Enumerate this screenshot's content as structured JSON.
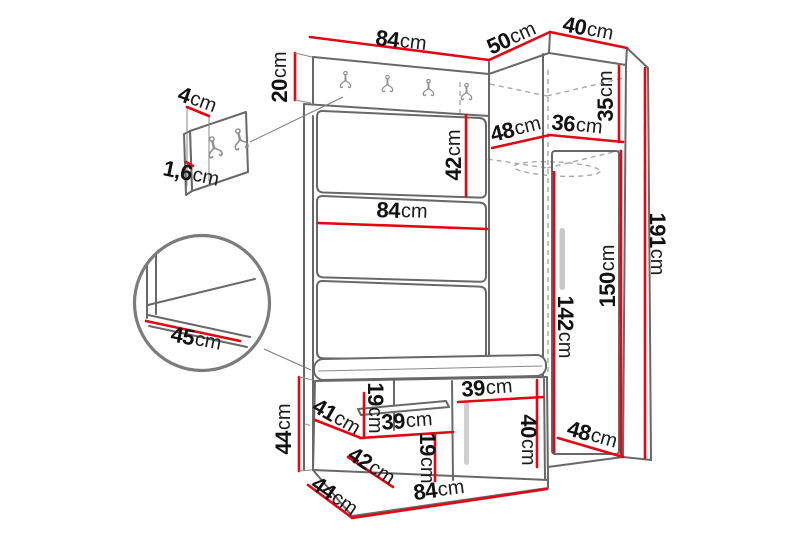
{
  "diagram": {
    "kind": "furniture-dimension-drawing",
    "unit": "cm",
    "colors": {
      "dimension_line": "#e30613",
      "outline": "#686868",
      "hidden_line": "#a9a9a9",
      "text": "#111111",
      "background": "#ffffff"
    },
    "icons": [
      {
        "name": "double-coat-hook",
        "count": 6
      },
      {
        "name": "magnifier-detail-circle",
        "count": 1
      }
    ]
  },
  "dims": [
    {
      "id": "top-width",
      "num": "84",
      "unit": "cm"
    },
    {
      "id": "corner-width",
      "num": "50",
      "unit": "cm"
    },
    {
      "id": "side-width",
      "num": "40",
      "unit": "cm"
    },
    {
      "id": "hanger-strip-height",
      "num": "20",
      "unit": "cm"
    },
    {
      "id": "hook-panel-depth",
      "num": "4",
      "unit": "cm"
    },
    {
      "id": "hook-panel-thickness",
      "num": "1,6",
      "unit": "cm"
    },
    {
      "id": "upper-panel-height",
      "num": "42",
      "unit": "cm"
    },
    {
      "id": "panel-width",
      "num": "84",
      "unit": "cm"
    },
    {
      "id": "corner-shelf-depth",
      "num": "48",
      "unit": "cm"
    },
    {
      "id": "corner-inner-width",
      "num": "36",
      "unit": "cm"
    },
    {
      "id": "top-compartment-height",
      "num": "35",
      "unit": "cm"
    },
    {
      "id": "total-height",
      "num": "191",
      "unit": "cm"
    },
    {
      "id": "door-height",
      "num": "150",
      "unit": "cm"
    },
    {
      "id": "interior-height",
      "num": "142",
      "unit": "cm"
    },
    {
      "id": "seat-depth",
      "num": "45",
      "unit": "cm"
    },
    {
      "id": "bench-height",
      "num": "44",
      "unit": "cm"
    },
    {
      "id": "bench-opening-width",
      "num": "41",
      "unit": "cm"
    },
    {
      "id": "bench-opening-height",
      "num": "19",
      "unit": "cm"
    },
    {
      "id": "bench-shelf-width",
      "num": "39",
      "unit": "cm"
    },
    {
      "id": "bench-door-width",
      "num": "39",
      "unit": "cm"
    },
    {
      "id": "bench-door-height",
      "num": "40",
      "unit": "cm"
    },
    {
      "id": "lower-opening-width",
      "num": "42",
      "unit": "cm"
    },
    {
      "id": "lower-opening-height",
      "num": "19",
      "unit": "cm"
    },
    {
      "id": "wardrobe-depth",
      "num": "48",
      "unit": "cm"
    },
    {
      "id": "bench-depth",
      "num": "44",
      "unit": "cm"
    },
    {
      "id": "bench-width",
      "num": "84",
      "unit": "cm"
    }
  ]
}
